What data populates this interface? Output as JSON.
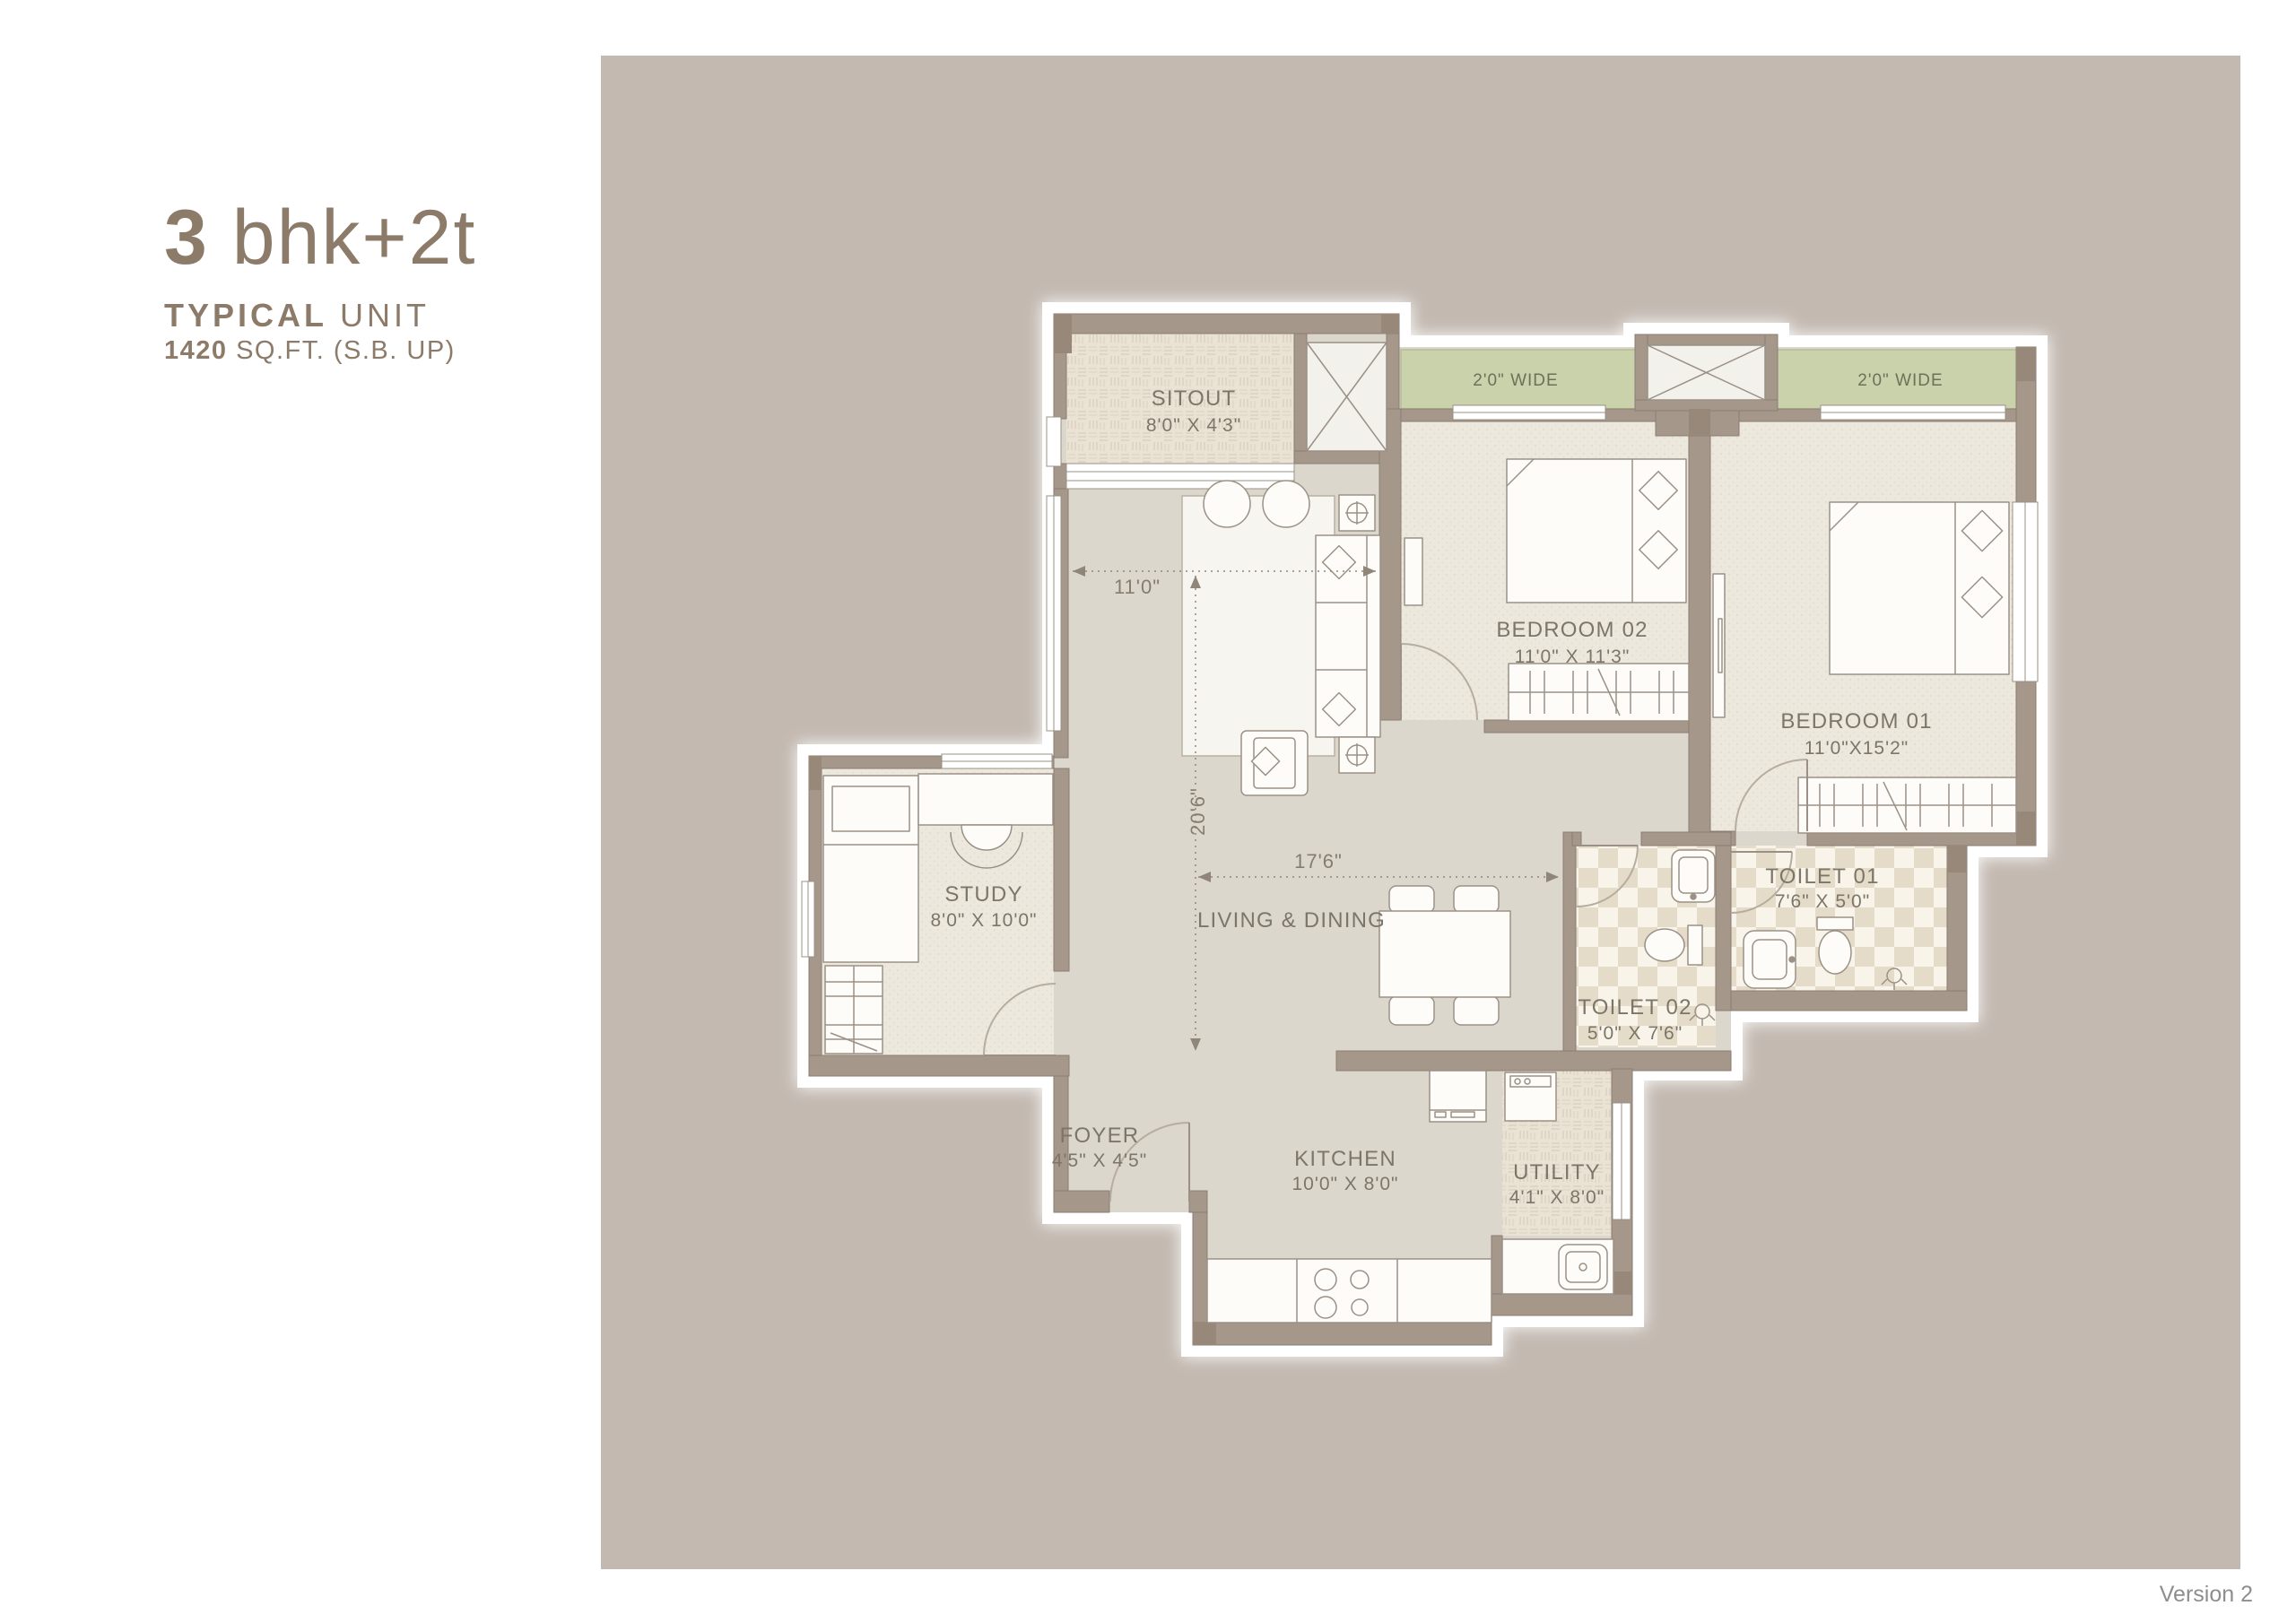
{
  "title": {
    "line1_bold": "3",
    "line1_light": " bhk+2t",
    "line2_bold": "TYPICAL",
    "line2_light": " UNIT",
    "line3_bold": "1420",
    "line3_light": " SQ.FT. (S.B. UP)"
  },
  "plan": {
    "rooms": {
      "sitout": {
        "name": "SITOUT",
        "dims": "8'0\" X 4'3\""
      },
      "bedroom02": {
        "name": "BEDROOM 02",
        "dims": "11'0\" X 11'3\""
      },
      "bedroom01": {
        "name": "BEDROOM 01",
        "dims": "11'0\"X15'2\""
      },
      "study": {
        "name": "STUDY",
        "dims": "8'0\" X 10'0\""
      },
      "living": {
        "name": "LIVING & DINING"
      },
      "toilet01": {
        "name": "TOILET 01",
        "dims": "7'6\" X 5'0\""
      },
      "toilet02": {
        "name": "TOILET 02",
        "dims": "5'0\" X 7'6\""
      },
      "foyer": {
        "name": "FOYER",
        "dims": "4'5\" X 4'5\""
      },
      "kitchen": {
        "name": "KITCHEN",
        "dims": "10'0\" X 8'0\""
      },
      "utility": {
        "name": "UTILITY",
        "dims": "4'1\" X 8'0\""
      }
    },
    "balconies": {
      "left": "2'0\" WIDE",
      "right": "2'0\" WIDE"
    },
    "dimensions": {
      "living_width": "11'0\"",
      "living_length": "20'6\"",
      "living_dining_width": "17'6\""
    }
  },
  "footer": {
    "version": "Version 2"
  },
  "colors": {
    "panel": "#c3b9b1",
    "wall": "#a5978a",
    "balcony_strip": "#c9d2ab",
    "title_text": "#8d7b69",
    "plan_text": "#7d7568",
    "floor_base": "#dcd7cd"
  }
}
